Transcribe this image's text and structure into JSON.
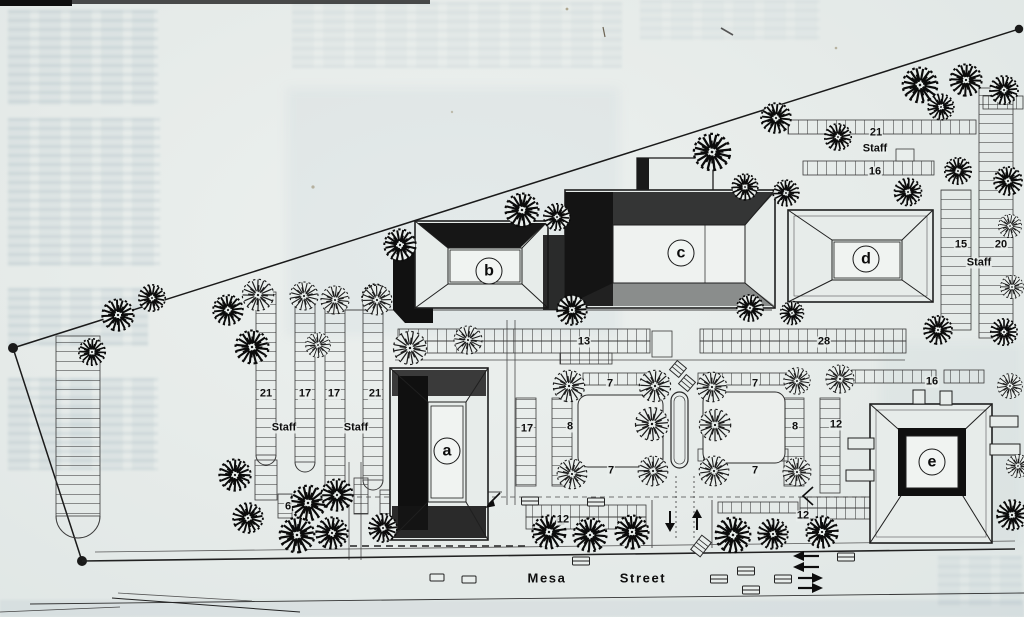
{
  "plan": {
    "street": {
      "word1": "Mesa",
      "word2": "Street"
    },
    "buildings": {
      "a": "a",
      "b": "b",
      "c": "c",
      "d": "d",
      "e": "e"
    },
    "parking": {
      "west_columns": [
        "21",
        "17",
        "17",
        "21"
      ],
      "west_staff": [
        "Staff",
        "Staff"
      ],
      "north_lot": "21",
      "north_staff": "Staff",
      "north_lot2": "16",
      "ne_lots": [
        "15",
        "20"
      ],
      "ne_staff": "Staff",
      "center_row_west": "13",
      "center_row_east": "28",
      "court_west": {
        "top": "7",
        "outer": "17",
        "inner": "8",
        "bottom": "7"
      },
      "court_east": {
        "top": "7",
        "inner": "8",
        "outer": "12",
        "bottom": "7"
      },
      "southeast_lot": "16",
      "south_lot_west": "12",
      "south_lot_east": "12",
      "southwest_stub": "6"
    }
  }
}
